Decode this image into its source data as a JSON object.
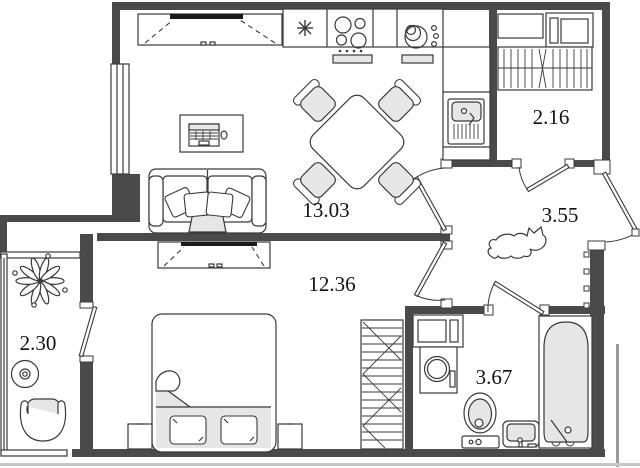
{
  "plan": {
    "rooms": [
      {
        "name": "living-kitchen",
        "area": "13.03"
      },
      {
        "name": "bedroom-corridor",
        "area": "12.36"
      },
      {
        "name": "hallway",
        "area": "3.55"
      },
      {
        "name": "storage",
        "area": "2.16"
      },
      {
        "name": "balcony",
        "area": "2.30"
      },
      {
        "name": "bathroom",
        "area": "3.67"
      }
    ],
    "colors": {
      "wall": "#4a4a4a",
      "line": "#3a3a3a",
      "furniture_fill": "#e6e6e6",
      "background": "#ffffff"
    },
    "icons": [
      "tv-icon",
      "sofa-icon",
      "desk-icon",
      "dining-set-icon",
      "fridge-icon",
      "stove-icon",
      "dish-rack-icon",
      "kitchen-sink-icon",
      "wardrobe-icon",
      "bed-icon",
      "nightstand-icon",
      "plant-icon",
      "coffee-table-icon",
      "armchair-icon",
      "cat-icon",
      "coat-hooks-icon",
      "washing-machine-icon",
      "toilet-icon",
      "wash-basin-icon",
      "bathtub-icon",
      "door-icon",
      "window-icon"
    ]
  }
}
